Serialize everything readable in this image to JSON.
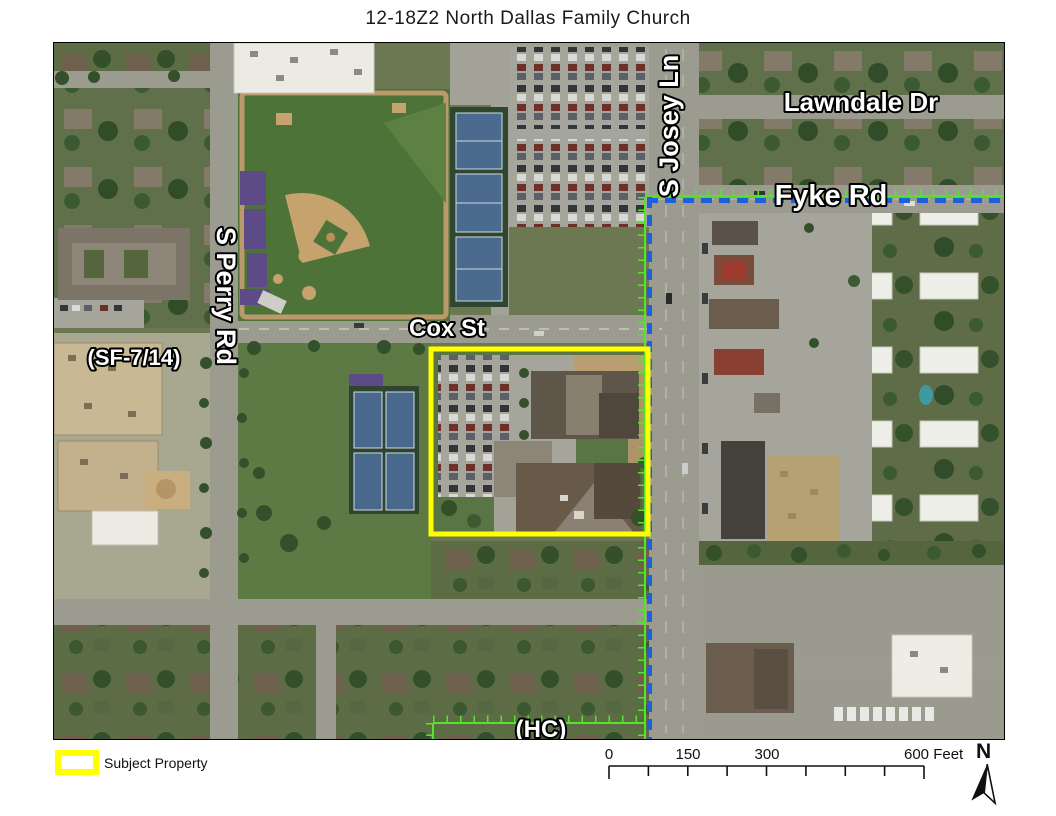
{
  "title": "12-18Z2 North Dallas Family Church",
  "map": {
    "street_labels": {
      "s_josey_ln": "S Josey Ln",
      "lawndale_dr": "Lawndale Dr",
      "fyke_rd": "Fyke Rd",
      "s_perry_rd": "S Perry Rd",
      "cox_st": "Cox St"
    },
    "zoning_labels": {
      "sf": "(SF-7/14)",
      "hc": "(HC)"
    }
  },
  "legend": {
    "subject_property": "Subject Property",
    "swatch_color": "#FFFF00"
  },
  "scale_bar": {
    "tick_0": "0",
    "tick_150": "150",
    "tick_300": "300",
    "end_label": "600 Feet"
  },
  "north_arrow_label": "N",
  "colors": {
    "subject_boundary": "#FFFF00",
    "zoning_boundary_blue": "#1E5FE0",
    "zoning_boundary_green": "#54E42A"
  }
}
